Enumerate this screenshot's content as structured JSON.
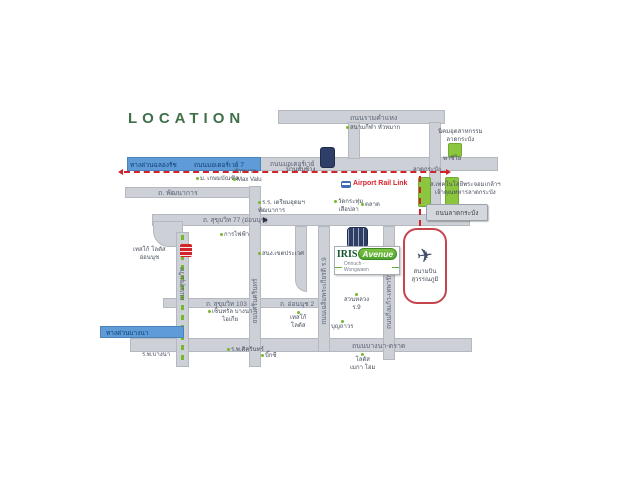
{
  "title": "LOCATION",
  "project": {
    "name_main": "IRIS",
    "name_sub": "Avenue",
    "subtitle": "Onnuch - Wongwaen"
  },
  "roads": {
    "ramkhamhaeng": "ถนนรามคำแหง",
    "tollway_chalongrat": "ทางด่วนฉลองรัช",
    "motorway7": "ถนนมอเตอร์เวย์ 7",
    "motorway": "ถนนมอเตอร์เวย์",
    "phatthanakan": "ถ. พัฒนาการ",
    "sukhumvit77": "ถ. สุขุมวิท 77 (อ่อนนุช)",
    "sukhumvit": "ถนนสุขุมวิท",
    "srinakarin": "ถนนศรีนครินทร์",
    "sukhumvit103": "ถ. สุขุมวิท 103",
    "onnut2": "ถ. อ่อนนุช 2",
    "chaloemphrakiat": "ถนนเฉลิมพระเกียรติ ร.9",
    "kingkaew": "ถนนกิ่งแก้ว-เทพารักษ์",
    "bangna_trat": "ถนนบางนา-ตราด",
    "tollway_bangna": "ทางด่วนบางนา",
    "latkrabang": "ถนนลาดกระบัง"
  },
  "rail": {
    "airport_rail_link": "Airport Rail Link",
    "station_huamak": "หัวหมาก",
    "station_banthapchang": "บ้านทับช้าง",
    "station_latkrabang": "ลาดกระบัง"
  },
  "airport": {
    "l1": "สนามบิน",
    "l2": "สุวรรณภูมิ"
  },
  "pois": {
    "kasembundit": {
      "l1": "ม. เกษมบัณฑิต"
    },
    "maxvalu": {
      "l1": "Max Valu"
    },
    "stadium": {
      "l1": "สนามกีฬา หัวหมาก"
    },
    "nikhom": {
      "l1": "นิคมอุตสาหกรรม",
      "l2": "ลาดกระบัง"
    },
    "paseo": {
      "l1": "พาซิโอ"
    },
    "kmitl": {
      "l1": "ส.เทคโนโลยีพระจอมเกล้าฯ",
      "l2": "เจ้าคุณทหารลาดกระบัง"
    },
    "triamudom": {
      "l1": "ร.ร. เตรียมอุดมฯ",
      "l2": "พัฒนาการ"
    },
    "watkrathum": {
      "l1": "วัดกระทุ่ม",
      "l2": "เสือปลา"
    },
    "talat": {
      "l1": "ตลาด"
    },
    "prawet": {
      "l1": "สนง.เขตประเวศ"
    },
    "electricity": {
      "l1": "การไฟฟ้า"
    },
    "tesco_onnut": {
      "l1": "เทสโก้ โลตัส",
      "l2": "อ่อนนุช"
    },
    "central_bangna": {
      "l1": "เซ็นทรัล บางนา",
      "l2": "ไอเกีย"
    },
    "tesco_srinut": {
      "l1": "เทสโก้",
      "l2": "โลตัส"
    },
    "boonthavorn": {
      "l1": "บุญถาวร"
    },
    "suanluang": {
      "l1": "สวนหลวง",
      "l2": "ร.9"
    },
    "sikarin": {
      "l1": "ร.พ.ศิครินทร์"
    },
    "bigc": {
      "l1": "บิ๊กซี"
    },
    "bangna_hospital": {
      "l1": "ร.พ.บางนา"
    },
    "lotus_mega": {
      "l1": "โลตัส",
      "l2": "เมกา โฮม"
    }
  },
  "colors": {
    "title_green": "#40704a",
    "marker_green": "#76b82a",
    "rail_red": "#d2232a",
    "road_gray": "#cdd0d6",
    "expressway_blue": "#5f9bd6",
    "navy_icon": "#2e3e66",
    "logo_green": "#5aae33"
  }
}
